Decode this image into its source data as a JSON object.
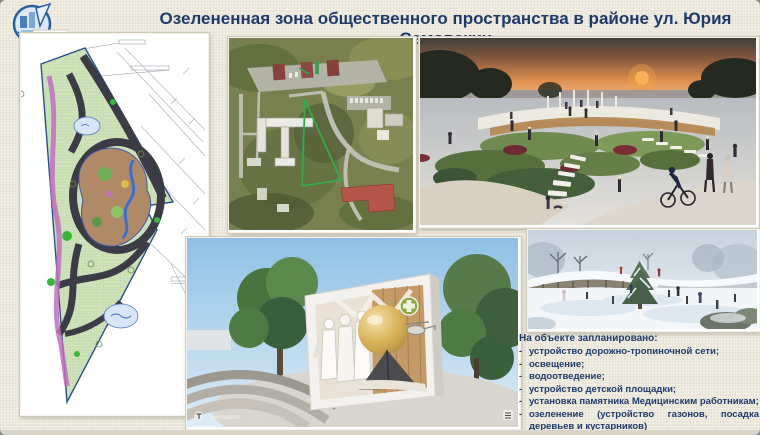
{
  "header": {
    "title": "Озелененная зона общественного пространства в районе ул. Юрия Семовских"
  },
  "logo": {
    "line1": "ВОСТОЧНЫЙ",
    "line2": "АДМИНИСТРАТИВНЫЙ",
    "line3": "ОКРУГ"
  },
  "planned": {
    "heading": "На объекте запланировано:",
    "bullet": "-",
    "items": [
      "устройство дорожно-тропиночной сети;",
      "освещение;",
      "водоотведение;",
      "устройство детской площадки;",
      "установка памятника Медицинским работникам;",
      "озеленение (устройство газонов, посадка деревьев и кустарников)"
    ]
  },
  "watermark": {
    "app": "Twinmotion",
    "edition": "Community Edition"
  },
  "colors": {
    "title_navy": "#1e3a6d",
    "slide_background": "#ece9dc",
    "site_outline_green": "#2fae4a"
  }
}
